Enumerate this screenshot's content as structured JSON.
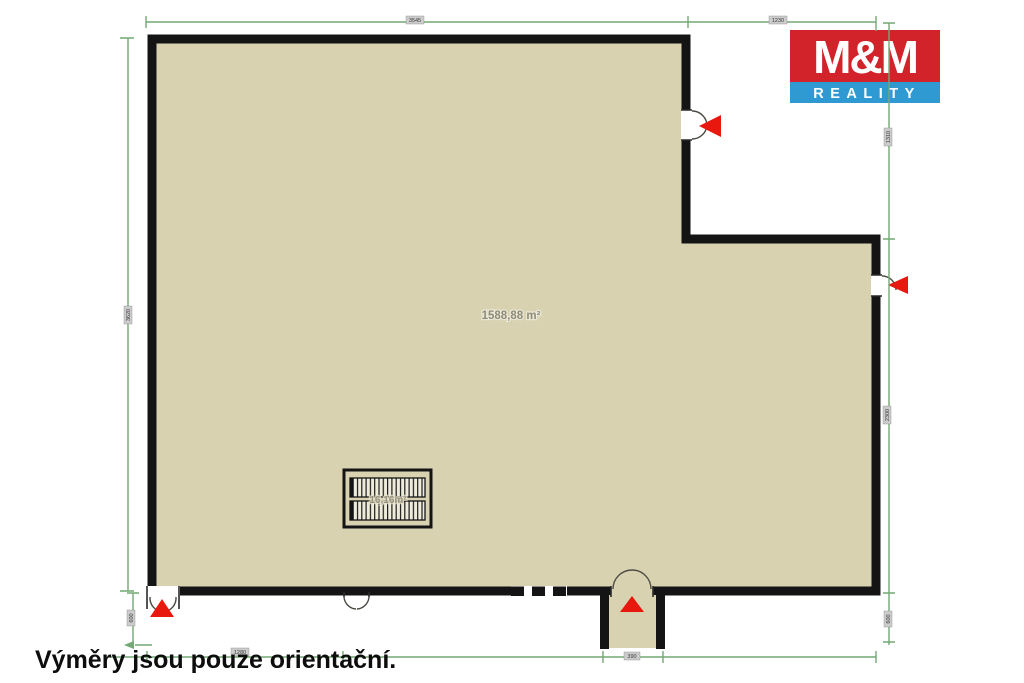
{
  "logo": {
    "title": "M&M",
    "subtitle": "REALITY"
  },
  "plan": {
    "area_label": "1588,88 m²",
    "stairs_area_label": "16,16m²"
  },
  "dimensions": {
    "top_main": "3545",
    "top_right": "1230",
    "notch_height": "1310",
    "left_height": "3620",
    "right_height": "2300",
    "bottom_left_offset": "600",
    "bottom_right_offset": "600",
    "bottom_left_span": "1280",
    "porch_width": "390"
  },
  "disclaimer": "Výměry jsou pouze orientační.",
  "colors": {
    "floor": "#d8d2b0",
    "wall": "#141414",
    "dimension": "#74a874",
    "marker": "#e8180f",
    "logo_red": "#d2232a",
    "logo_blue": "#2f9ad2"
  }
}
